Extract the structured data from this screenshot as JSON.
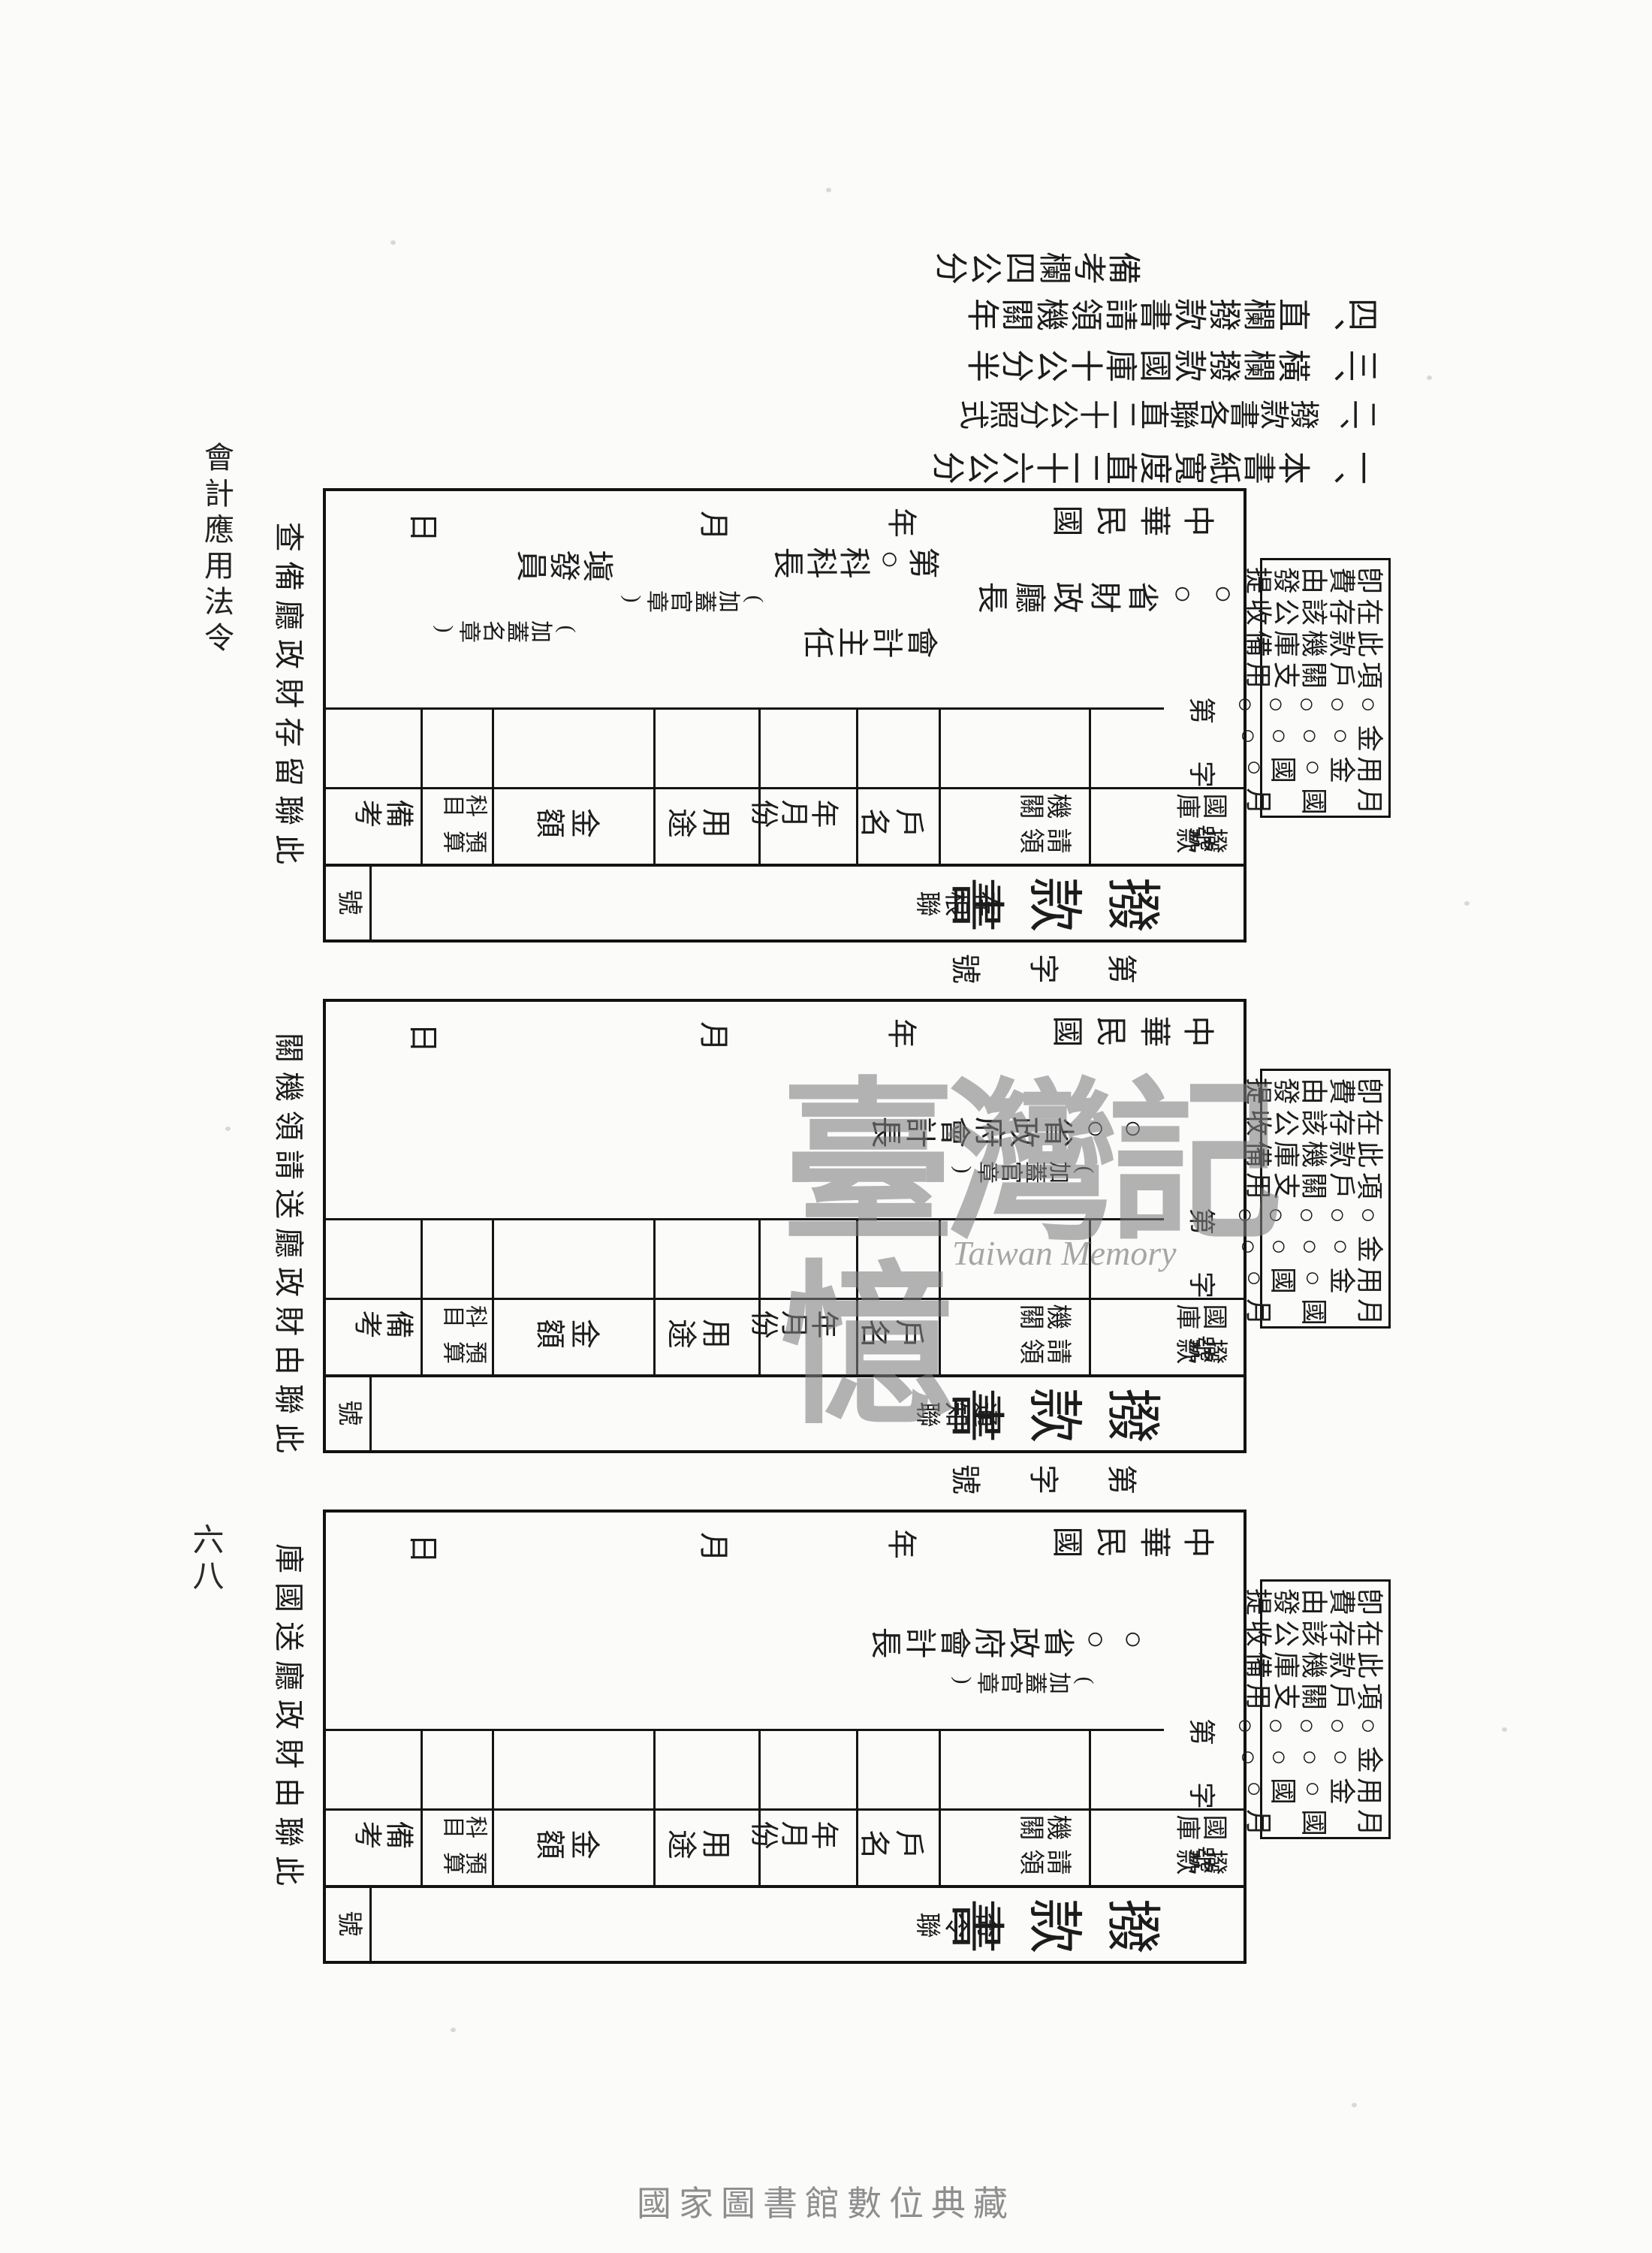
{
  "page": {
    "margin_title": "會計應用法令",
    "page_number": "六八",
    "watermark_cn": "臺灣記憶",
    "watermark_en": "Taiwan Memory",
    "footer": "國家圖書館數位典藏",
    "ink_color": "#1c1c1c",
    "watermark_color": "#7d7d7d"
  },
  "instructions": {
    "items": [
      "一、本書紙寬度直二十六公分",
      "二、撥款書各聯直二十公分照式",
      "三、橫欄撥款國庫十公分半",
      "四、直欄撥款書請領機關年",
      "備考欄四公分"
    ]
  },
  "note_box": {
    "lines": [
      "卽費由發提",
      "在存該公收",
      "此款機庫備",
      "項戶關支用",
      "○○○○○",
      "金○○○○",
      "用金○國○",
      "月　國　月"
    ]
  },
  "serial_between": "第　字　號",
  "serial_internal": "第 字 號",
  "labels": {
    "beikao": "備考",
    "kemu": "科目",
    "yusuan": "預算",
    "jine": "金額",
    "yongtu": "用途",
    "nianyuefen": "年月份",
    "huming": "戶名",
    "qingling": "請領",
    "jiguan": "機關",
    "bokuan": "撥款",
    "guoku": "國庫",
    "hao": "號"
  },
  "forms": [
    {
      "title": "撥款書",
      "copy_label": "存根聯",
      "caption": "此聯留存財政廳備查",
      "date": [
        "中華民國",
        "年",
        "月",
        "日"
      ],
      "signers": [
        {
          "text": "○○省財政廳長",
          "slot": "chief"
        },
        {
          "text": "(加蓋官章)",
          "slot": "chief_seal"
        },
        {
          "text": "第○科科長",
          "slot": "officer_a"
        },
        {
          "text": "塡發員",
          "slot": "officer_b"
        },
        {
          "text": "(加蓋名章)",
          "slot": "name_seal"
        },
        {
          "text": "會計主任",
          "slot": "accountant"
        }
      ]
    },
    {
      "title": "撥款書",
      "copy_label": "通知聯",
      "caption": "此聯由財政廳送請領機關",
      "date": [
        "中華民國",
        "年",
        "月",
        "日"
      ],
      "signers": [
        {
          "text": "○○省政府會計長",
          "slot": "chief2"
        },
        {
          "text": "(加蓋官章)",
          "slot": "chief2_seal"
        }
      ]
    },
    {
      "title": "撥款書",
      "copy_label": "命令聯",
      "caption": "此聯由財政廳送國庫",
      "date": [
        "中華民國",
        "年",
        "月",
        "日"
      ],
      "signers": [
        {
          "text": "○○省政府會計長",
          "slot": "chief2"
        },
        {
          "text": "(加蓋官章)",
          "slot": "chief2_seal"
        }
      ]
    }
  ]
}
